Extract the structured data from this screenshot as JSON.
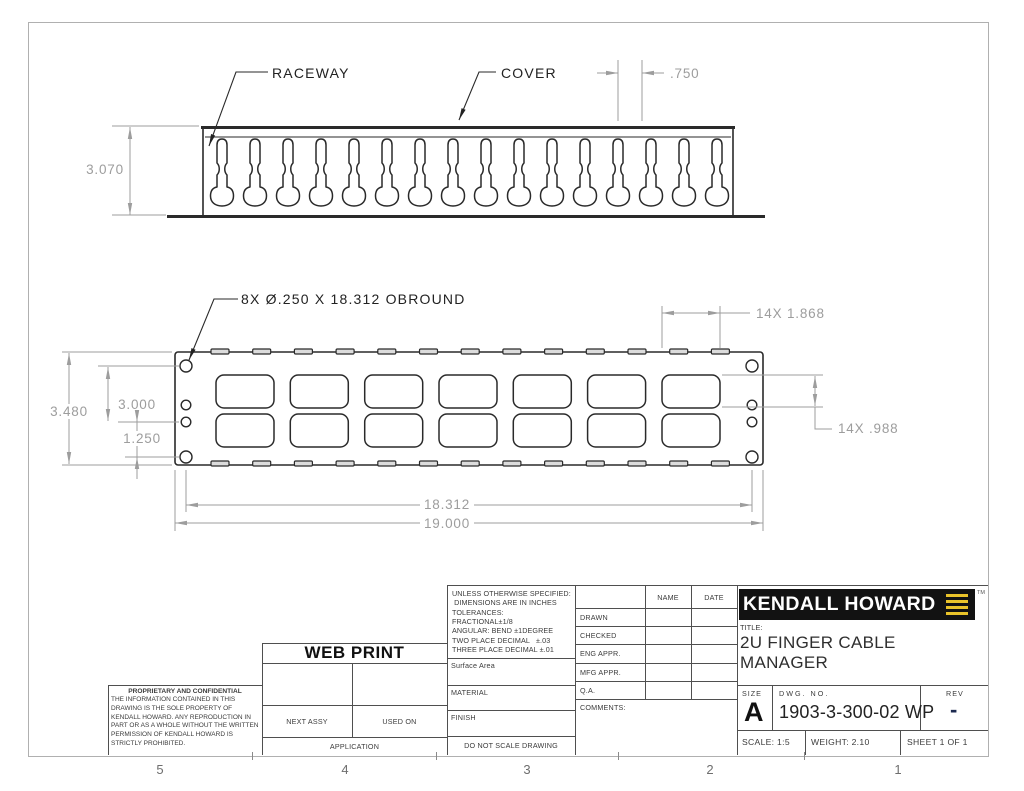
{
  "zones": [
    "5",
    "4",
    "3",
    "2",
    "1"
  ],
  "colors": {
    "geometry_line": "#2a2a2a",
    "dimension_line": "#9d9d9d",
    "logo_background": "#121212",
    "logo_yellow": "#e9c32a",
    "rev_dash_navy": "#1c2a50"
  },
  "top_view": {
    "raceway_label": "RACEWAY",
    "cover_label": "COVER",
    "dim_finger_pitch": ".750",
    "dim_height": "3.070"
  },
  "front_view": {
    "hole_callout": "8X  Ø.250  X  18.312  OBROUND",
    "dim_overall_height": "3.480",
    "dim_hole_span_vertical": "3.000",
    "dim_hole_gap": "1.250",
    "dim_opening_width": "14X 1.868",
    "dim_opening_height": "14X .988",
    "dim_hole_span_horizontal": "18.312",
    "dim_overall_width": "19.000"
  },
  "title_block": {
    "notes_text": "UNLESS OTHERWISE SPECIFIED:\n DIMENSIONS ARE IN INCHES\nTOLERANCES:\nFRACTIONAL±1/8\nANGULAR: BEND ±1DEGREE\nTWO PLACE DECIMAL   ±.03\nTHREE PLACE DECIMAL ±.01",
    "surface_area": "Surface Area",
    "material": "MATERIAL",
    "finish": "FINISH",
    "do_not_scale": "DO NOT SCALE DRAWING",
    "name_header": "NAME",
    "date_header": "DATE",
    "approval_rows": [
      {
        "label": "DRAWN"
      },
      {
        "label": "CHECKED"
      },
      {
        "label": "ENG APPR."
      },
      {
        "label": "MFG APPR."
      },
      {
        "label": "Q.A."
      }
    ],
    "comments_label": "COMMENTS:",
    "web_print": "WEB PRINT",
    "proprietary_title": "PROPRIETARY AND CONFIDENTIAL",
    "proprietary_body": "THE INFORMATION CONTAINED IN THIS DRAWING IS THE SOLE PROPERTY OF KENDALL HOWARD.  ANY REPRODUCTION IN PART OR AS A WHOLE WITHOUT THE WRITTEN PERMISSION OF KENDALL HOWARD IS STRICTLY PROHIBITED.",
    "next_assy": "NEXT ASSY",
    "used_on": "USED ON",
    "application": "APPLICATION",
    "logo_text": "KENDALL HOWARD",
    "trademark": "TM",
    "title_label": "TITLE:",
    "title": "2U FINGER CABLE\nMANAGER",
    "size_label": "SIZE",
    "size": "A",
    "dwg_label": "DWG.  NO.",
    "dwg_no": "1903-3-300-02 WP",
    "rev_label": "REV",
    "rev": "-",
    "scale": "SCALE: 1:5",
    "weight": "WEIGHT: 2.10",
    "sheet": "SHEET 1 OF 1"
  }
}
